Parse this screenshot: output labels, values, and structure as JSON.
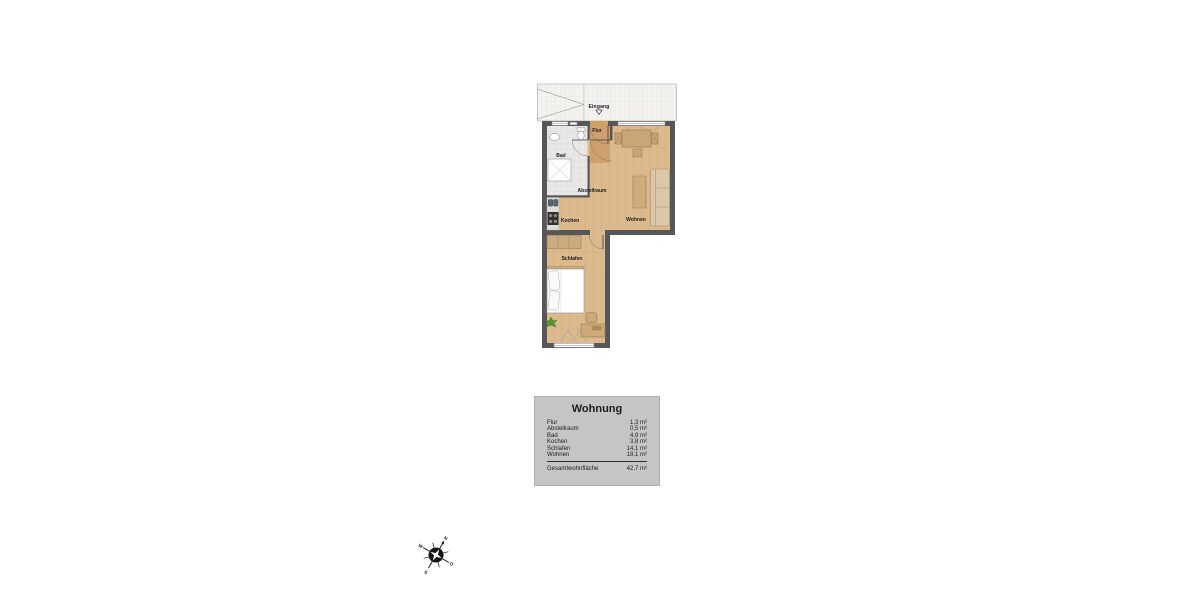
{
  "plan": {
    "entrance_label": "Eingang",
    "rooms": [
      {
        "id": "flur",
        "label": "Flur"
      },
      {
        "id": "bad",
        "label": "Bad"
      },
      {
        "id": "abstellraum",
        "label": "Abstellraum"
      },
      {
        "id": "kochen",
        "label": "Kochen"
      },
      {
        "id": "wohnen",
        "label": "Wohnen"
      },
      {
        "id": "schlafen",
        "label": "Schlafen"
      }
    ]
  },
  "legend": {
    "title": "Wohnung",
    "rows": [
      {
        "label": "Flur",
        "value": "1,3 m²"
      },
      {
        "label": "Abstellraum",
        "value": "0,5 m²"
      },
      {
        "label": "Bad",
        "value": "4,9 m²"
      },
      {
        "label": "Kochen",
        "value": "3,8 m²"
      },
      {
        "label": "Schlafen",
        "value": "14,1 m²"
      },
      {
        "label": "Wohnen",
        "value": "18,1 m²"
      }
    ],
    "total": {
      "label": "Gesamtwohnfläche",
      "value": "42,7 m²"
    }
  },
  "compass": {
    "n": "N",
    "o": "O",
    "s": "S",
    "w": "W"
  },
  "colors": {
    "wall": "#575757",
    "wood_floor": "#dcba8e",
    "hall_floor": "#c08046",
    "bath_tile": "#e9e8e6",
    "walkway": "#f4f3f0",
    "legend_bg": "#c5c5c5",
    "furniture_tan": "#cfab7d",
    "appliance_dark": "#2f2f2f",
    "plant_green": "#55932e"
  }
}
